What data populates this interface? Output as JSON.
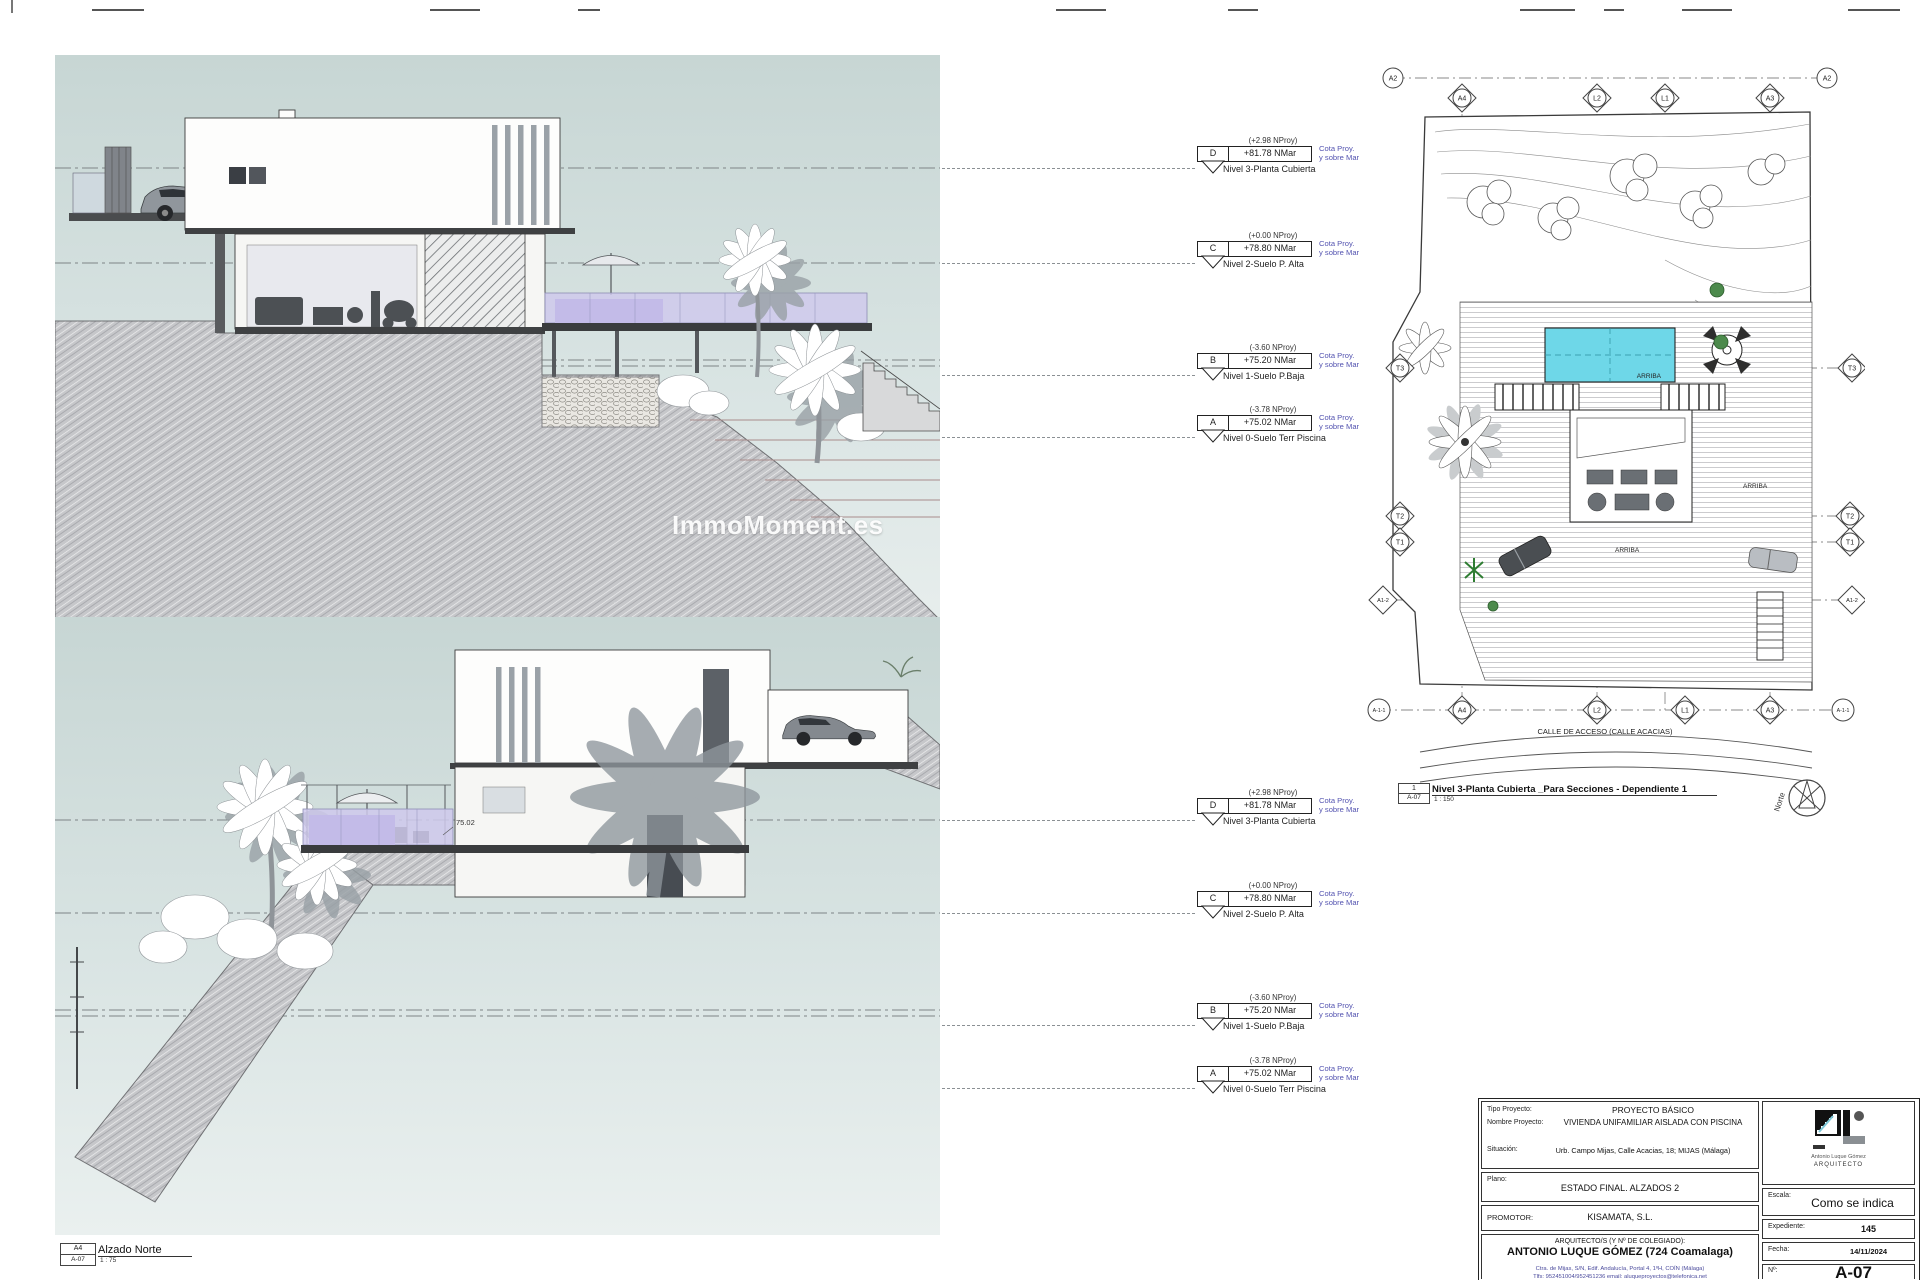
{
  "watermark": "ImmoMoment.es",
  "levels": [
    {
      "letter": "D",
      "nproy": "(+2.98 NProy)",
      "cota": "+81.78 NMar",
      "note1": "Cota Proy.",
      "note2": "y sobre Mar",
      "nivel": "Nivel 3-Planta Cubierta"
    },
    {
      "letter": "C",
      "nproy": "(+0.00 NProy)",
      "cota": "+78.80 NMar",
      "note1": "Cota Proy.",
      "note2": "y sobre Mar",
      "nivel": "Nivel 2-Suelo P. Alta"
    },
    {
      "letter": "B",
      "nproy": "(-3.60 NProy)",
      "cota": "+75.20 NMar",
      "note1": "Cota Proy.",
      "note2": "y sobre Mar",
      "nivel": "Nivel 1-Suelo P.Baja"
    },
    {
      "letter": "A",
      "nproy": "(-3.78 NProy)",
      "cota": "+75.02 NMar",
      "note1": "Cota Proy.",
      "note2": "y sobre Mar",
      "nivel": "Nivel 0-Suelo Terr Piscina"
    }
  ],
  "elevation_sur": {
    "ref": "A3",
    "sheet": "A-07",
    "title": "Alzado Sur",
    "scale": "1 : 75"
  },
  "elevation_norte": {
    "ref": "A4",
    "sheet": "A-07",
    "title": "Alzado Norte",
    "scale": "1 : 75",
    "pool_level": "75.02"
  },
  "site_plan": {
    "ref": "1",
    "sheet": "A-07",
    "title": "Nivel 3-Planta Cubierta _Para Secciones - Dependiente 1",
    "scale": "1 : 150",
    "street": "CALLE DE ACCESO (CALLE ACACIAS)",
    "north": "Norte",
    "arriba": "ARRIBA",
    "grid": {
      "a2": "A2",
      "a4": "A4",
      "l2": "L2",
      "l1": "L1",
      "a3": "A3",
      "a11": "A-1-1",
      "t3": "T3",
      "t2": "T2",
      "t1": "T1",
      "a12": "A1-2"
    }
  },
  "title_block": {
    "tipo_label": "Tipo Proyecto:",
    "tipo": "PROYECTO BÁSICO",
    "nombre_label": "Nombre Proyecto:",
    "nombre": "VIVIENDA UNIFAMILIAR AISLADA CON PISCINA",
    "situacion_label": "Situación:",
    "situacion": "Urb. Campo Mijas, Calle Acacias, 18; MIJAS (Málaga)",
    "plano_label": "Plano:",
    "plano": "ESTADO FINAL. ALZADOS 2",
    "promotor_label": "PROMOTOR:",
    "promotor": "KISAMATA, S.L.",
    "arquitecto_label": "ARQUITECTO/S (Y Nº DE COLEGIADO):",
    "arquitecto": "ANTONIO LUQUE GÓMEZ (724 Coamalaga)",
    "address": "Ctra. de Mijas, S/N, Edif. Andalucía, Portal 4, 1ºH, COÍN (Málaga)",
    "contact": "Tlfs: 952451004/952451236  email: aluqueproyectos@telefonica.net",
    "logo_name": "Antonio Luque Gómez",
    "logo_title": "ARQUITECTO",
    "escala_label": "Escala:",
    "escala": "Como se indica",
    "expediente_label": "Expediente:",
    "expediente": "145",
    "fecha_label": "Fecha:",
    "fecha": "14/11/2024",
    "num_label": "Nº:",
    "num": "A-07"
  },
  "colors": {
    "pool": "#6ed7e8",
    "glass": "#cfc9ec",
    "accent_blue": "#5353b0",
    "sky_top": "#c7d6d4",
    "sky_bottom": "#e7eeee"
  }
}
